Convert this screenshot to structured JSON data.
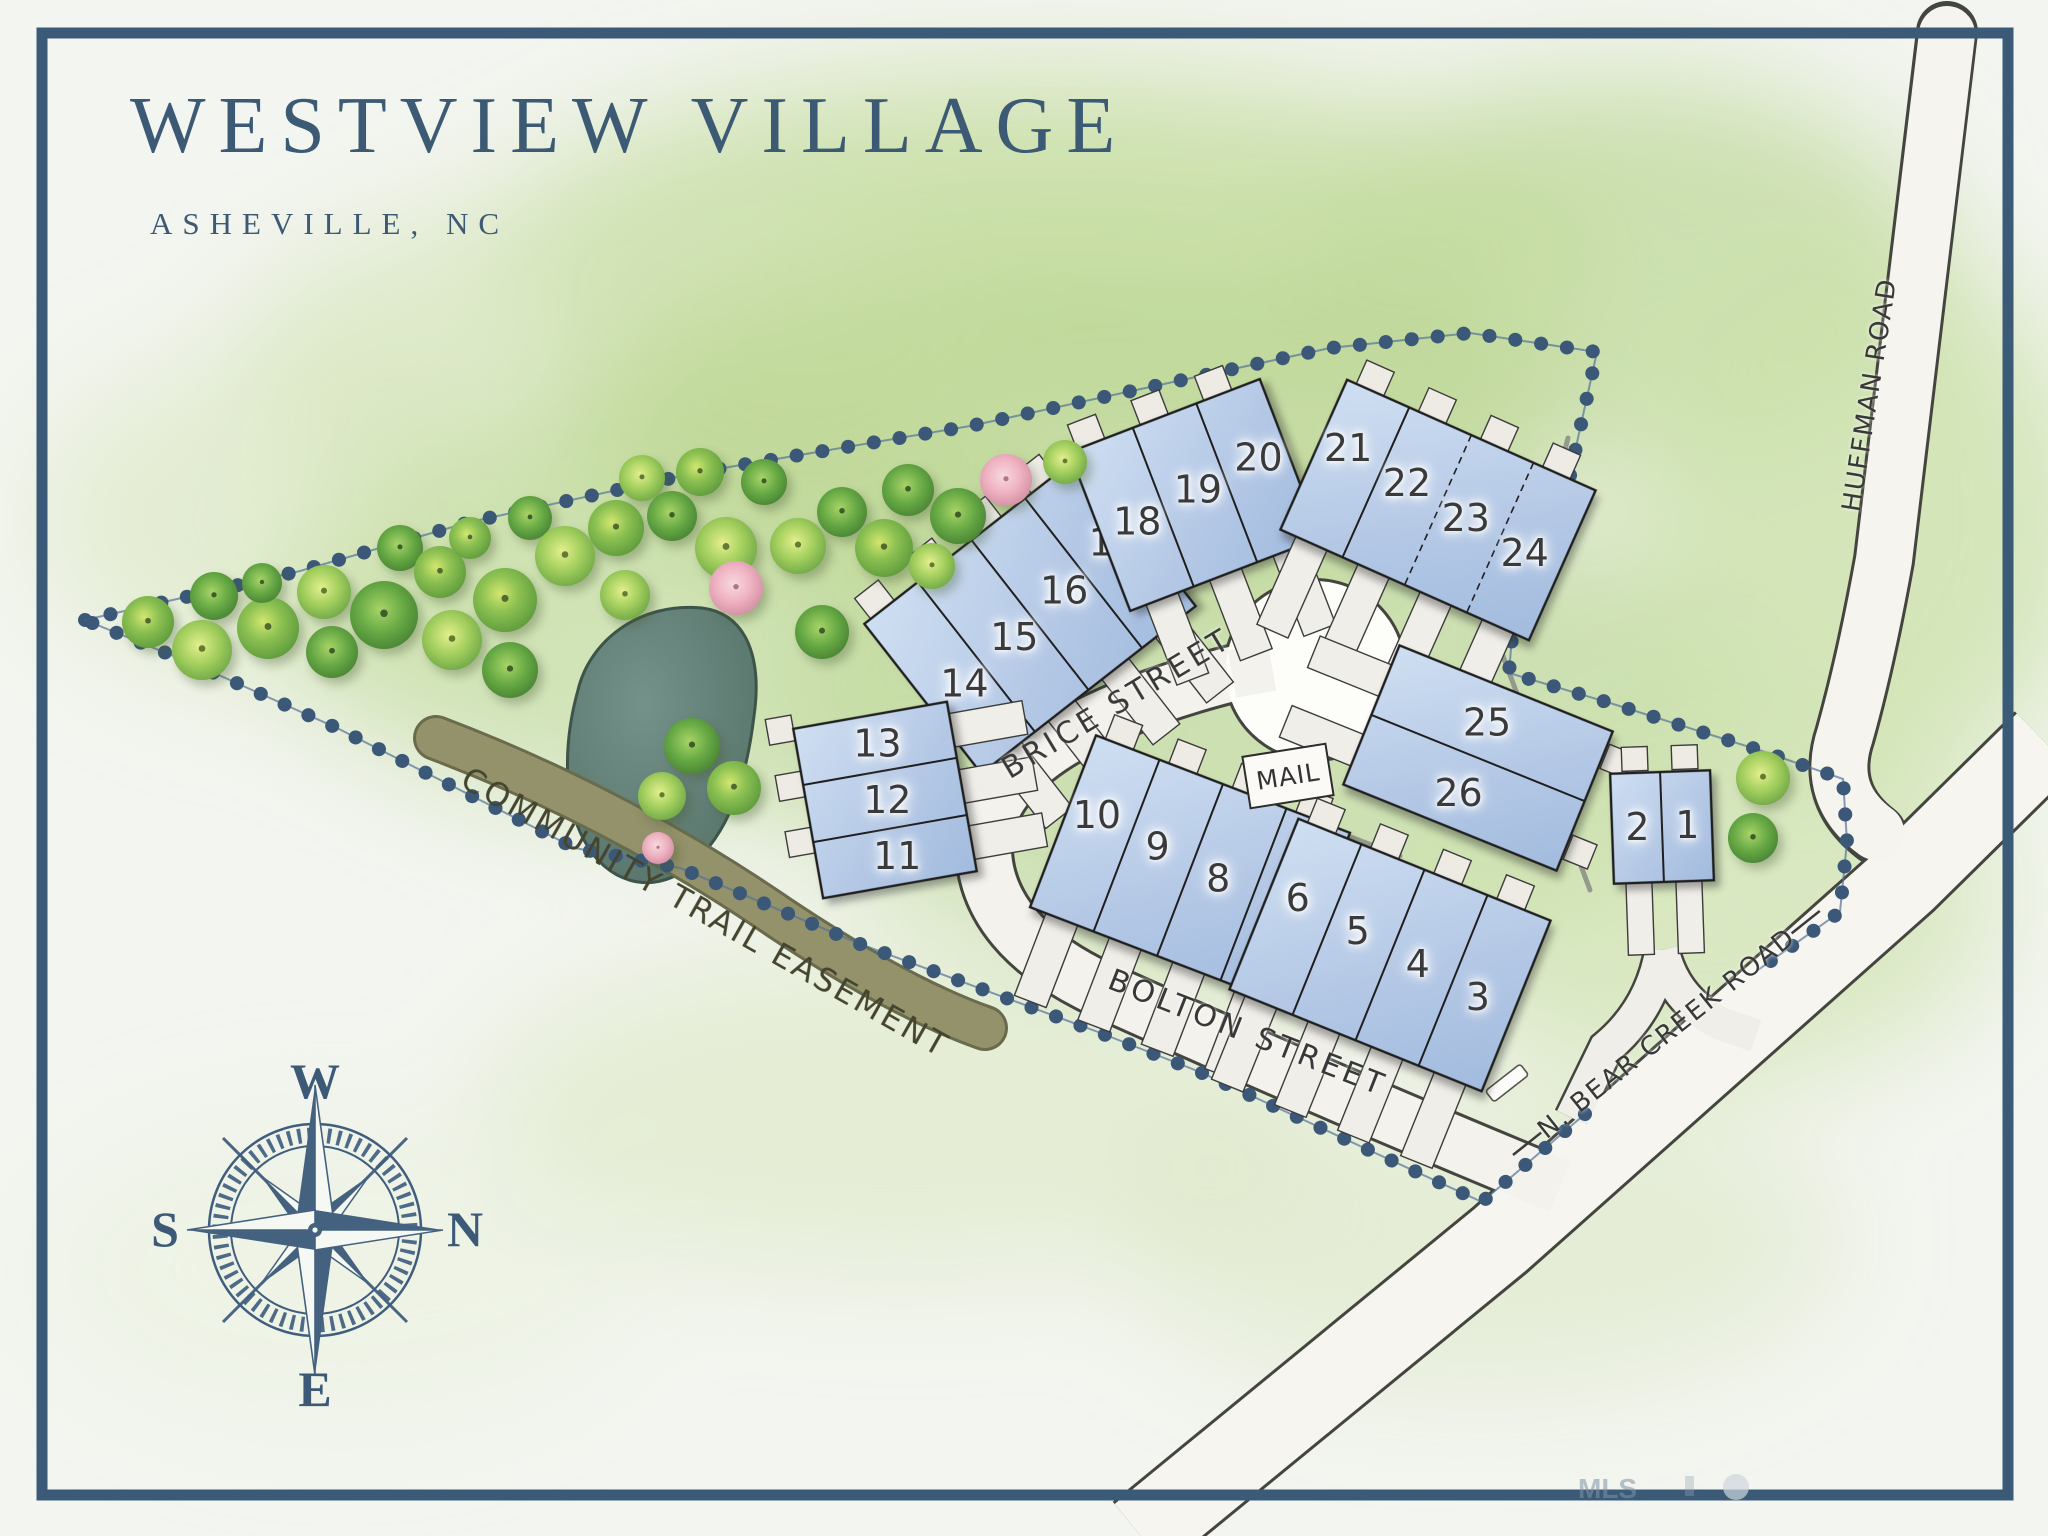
{
  "title": "WESTVIEW VILLAGE",
  "subtitle": "ASHEVILLE, NC",
  "compass": {
    "west": "W",
    "north": "N",
    "east": "E",
    "south": "S"
  },
  "streets": {
    "brice": "BRICE STREET",
    "bolton": "BOLTON STREET",
    "bear_creek": "N. BEAR CREEK ROAD",
    "huffman": "HUFFMAN ROAD"
  },
  "labels": {
    "mail": "MAIL",
    "trail": "COMMUNITY TRAIL EASEMENT"
  },
  "watermark": "MLS",
  "clusters": [
    {
      "id": "lots-1-2",
      "units": [
        "2",
        "1"
      ]
    },
    {
      "id": "lots-3-6",
      "units": [
        "6",
        "5",
        "4",
        "3"
      ]
    },
    {
      "id": "lots-7-10",
      "units": [
        "10",
        "9",
        "8",
        "7"
      ]
    },
    {
      "id": "lots-11-13",
      "units": [
        "13",
        "12",
        "11"
      ]
    },
    {
      "id": "lots-14-17",
      "units": [
        "14",
        "15",
        "16",
        "17"
      ]
    },
    {
      "id": "lots-18-20",
      "units": [
        "18",
        "19",
        "20"
      ]
    },
    {
      "id": "lots-21-24",
      "units": [
        "21",
        "22",
        "23",
        "24"
      ]
    },
    {
      "id": "lots-25-26",
      "units": [
        "25",
        "26"
      ]
    }
  ],
  "colors": {
    "accent": "#3c5a78",
    "building_fill": "#b9cce8",
    "road_fill": "#f3f2ec",
    "boundary_dot": "#3b5878",
    "trail": "#8f8e66",
    "pond": "#5f7b71",
    "canvas_green": "#c9dfa6"
  }
}
